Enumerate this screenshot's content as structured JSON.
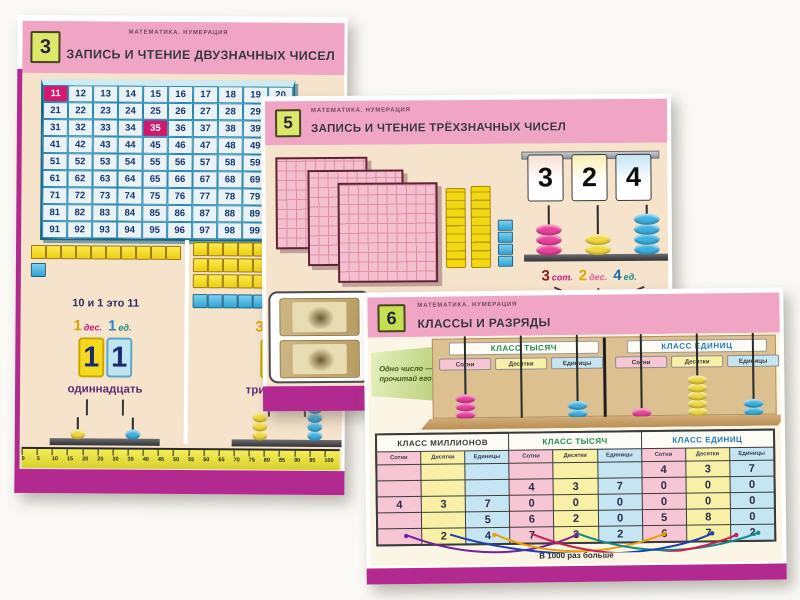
{
  "page": {
    "background": "#faf9f5"
  },
  "colors": {
    "accent_magenta": "#b22a90",
    "header_pink": "#f0a5c5",
    "badge_green": "#dde76a",
    "body_beige": "#f5e3cc",
    "grid_blue": "#2a86ad",
    "highlight_pink": "#d6176e",
    "col_pink": "#f6c6d4",
    "col_yellow": "#f9f0a8",
    "col_blue": "#c5e5f2"
  },
  "poster3": {
    "badge": "3",
    "series": "МАТЕМАТИКА. НУМЕРАЦИЯ",
    "title": "ЗАПИСЬ И ЧТЕНИЕ ДВУЗНАЧНЫХ ЧИСЕЛ",
    "grid": {
      "rows": [
        [
          11,
          12,
          13,
          14,
          15,
          16,
          17,
          18,
          19,
          20
        ],
        [
          21,
          22,
          23,
          24,
          25,
          26,
          27,
          28,
          29,
          30
        ],
        [
          31,
          32,
          33,
          34,
          35,
          36,
          37,
          38,
          39,
          40
        ],
        [
          41,
          42,
          43,
          44,
          45,
          46,
          47,
          48,
          49,
          50
        ],
        [
          51,
          52,
          53,
          54,
          55,
          56,
          57,
          58,
          59,
          60
        ],
        [
          61,
          62,
          63,
          64,
          65,
          66,
          67,
          68,
          69,
          70
        ],
        [
          71,
          72,
          73,
          74,
          75,
          76,
          77,
          78,
          79,
          80
        ],
        [
          81,
          82,
          83,
          84,
          85,
          86,
          87,
          88,
          89,
          90
        ],
        [
          91,
          92,
          93,
          94,
          95,
          96,
          97,
          98,
          99,
          100
        ]
      ],
      "highlighted": [
        11,
        35
      ]
    },
    "left_demo": {
      "tens_rows": 1,
      "unit_cubes": 1,
      "caption": "10 и 1 это 11",
      "decomposition": [
        {
          "num": "1",
          "num_color": "#d8a800",
          "unit": "дес.",
          "unit_color": "#c2187a"
        },
        {
          "num": "1",
          "num_color": "#2e86c8",
          "unit": "ед.",
          "unit_color": "#1a8a8a"
        }
      ],
      "number_digits": [
        "1",
        "1"
      ],
      "word": "одиннадцать",
      "abacus": [
        {
          "color": "#f0d840",
          "count": 1
        },
        {
          "color": "#3fb0de",
          "count": 1
        }
      ]
    },
    "right_demo": {
      "tens_rows": 3,
      "unit_cubes": 5,
      "decomposition": [
        {
          "num": "3",
          "num_color": "#d8a800",
          "unit": "дес.",
          "unit_color": "#c2187a"
        },
        {
          "num": "5",
          "num_color": "#2e86c8",
          "unit": "ед.",
          "unit_color": "#1a8a8a"
        }
      ],
      "number_digits": [
        "3",
        "5"
      ],
      "word": "тридцать пять",
      "abacus": [
        {
          "color": "#f0d840",
          "count": 3
        },
        {
          "color": "#3fb0de",
          "count": 5
        }
      ]
    },
    "ruler_numbers": [
      0,
      5,
      10,
      15,
      20,
      25,
      30,
      35,
      40,
      45,
      50,
      55,
      60,
      65,
      70,
      75,
      80,
      85,
      90,
      95,
      100
    ]
  },
  "poster5": {
    "badge": "5",
    "series": "МАТЕМАТИКА. НУМЕРАЦИЯ",
    "title": "ЗАПИСЬ И ЧТЕНИЕ ТРЁХЗНАЧНЫХ ЧИСЕЛ",
    "blocks": {
      "hundred_squares": 3,
      "ten_rods": 2,
      "unit_cubes": 4
    },
    "flip_cards": [
      {
        "digit": "3",
        "tint": "#f6e2d8"
      },
      {
        "digit": "2",
        "tint": "#f8f0b4"
      },
      {
        "digit": "4",
        "tint": "#c6e5f4"
      }
    ],
    "abacus": [
      {
        "color": "#e8439b",
        "count": 3
      },
      {
        "color": "#f0d840",
        "count": 2
      },
      {
        "color": "#3fb0de",
        "count": 4
      }
    ],
    "decomposition": [
      {
        "num": "3",
        "num_color": "#8b1a1a",
        "unit": "сот.",
        "unit_color": "#c2187a"
      },
      {
        "num": "2",
        "num_color": "#d8a800",
        "unit": "дес.",
        "unit_color": "#e060a0"
      },
      {
        "num": "4",
        "num_color": "#1f6fae",
        "unit": "ед.",
        "unit_color": "#1a8a8a"
      }
    ],
    "banknotes": 2
  },
  "poster6": {
    "badge": "6",
    "series": "МАТЕМАТИКА. НУМЕРАЦИЯ",
    "title": "КЛАССЫ И РАЗРЯДЫ",
    "tag_lines": [
      "Одно число —",
      "прочитай его!"
    ],
    "abacus": {
      "class_labels": [
        "КЛАСС ТЫСЯЧ",
        "КЛАСС ЕДИНИЦ"
      ],
      "rod_labels": [
        "Сотни",
        "Десятки",
        "Единицы",
        "Сотни",
        "Десятки",
        "Единицы"
      ],
      "beads": [
        {
          "color": "#e8439b",
          "count": 3
        },
        {
          "color": "#f0d840",
          "count": 0
        },
        {
          "color": "#3fb0de",
          "count": 2
        },
        {
          "color": "#e8439b",
          "count": 1
        },
        {
          "color": "#f0d840",
          "count": 5
        },
        {
          "color": "#3fb0de",
          "count": 2
        }
      ]
    },
    "table": {
      "class_headers": [
        "КЛАСС МИЛЛИОНОВ",
        "КЛАСС ТЫСЯЧ",
        "КЛАСС ЕДИНИЦ"
      ],
      "col_headers": [
        "Сотни",
        "Десятки",
        "Единицы",
        "Сотни",
        "Десятки",
        "Единицы",
        "Сотни",
        "Десятки",
        "Единицы"
      ],
      "rows": [
        [
          "",
          "",
          "",
          "",
          "",
          "",
          "4",
          "3",
          "7"
        ],
        [
          "",
          "",
          "",
          "4",
          "3",
          "7",
          "0",
          "0",
          "0"
        ],
        [
          "4",
          "3",
          "7",
          "0",
          "0",
          "0",
          "0",
          "0",
          "0"
        ],
        [
          "",
          "",
          "5",
          "6",
          "2",
          "0",
          "5",
          "8",
          "0"
        ],
        [
          "",
          "2",
          "4",
          "7",
          "3",
          "2",
          "6",
          "7",
          "2"
        ]
      ]
    },
    "footer": "В 1000 раз больше"
  }
}
